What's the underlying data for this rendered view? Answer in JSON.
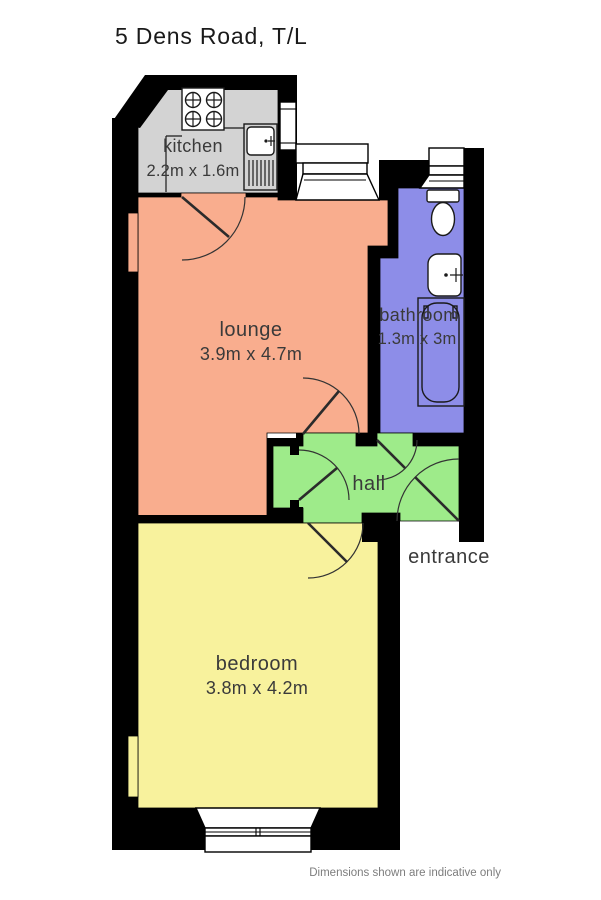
{
  "title": "5 Dens Road, T/L",
  "footer": "Dimensions shown are indicative only",
  "entrance_label": "entrance",
  "colors": {
    "wall": "#000000",
    "label": "#3a3a3a",
    "title": "#1a1a1a",
    "footer": "#7d7d7d",
    "window_fill": "#ffffff"
  },
  "rooms": {
    "kitchen": {
      "label": "kitchen",
      "dims": "2.2m x 1.6m",
      "color": "#d3d3d3"
    },
    "lounge": {
      "label": "lounge",
      "dims": "3.9m x 4.7m",
      "color": "#f9ad8e"
    },
    "bathroom": {
      "label": "bathroom",
      "dims": "1.3m x 3m",
      "color": "#8d8de8"
    },
    "hall": {
      "label": "hall",
      "color": "#9eeb8a"
    },
    "bedroom": {
      "label": "bedroom",
      "dims": "3.8m x 4.2m",
      "color": "#f8f29d"
    }
  },
  "icons": [
    "stove-icon",
    "sink-icon",
    "toilet-icon",
    "basin-icon",
    "bathtub-icon",
    "kitchen-window",
    "lounge-bay-window",
    "bathroom-window",
    "bedroom-bay-window",
    "door-swing-icon"
  ]
}
